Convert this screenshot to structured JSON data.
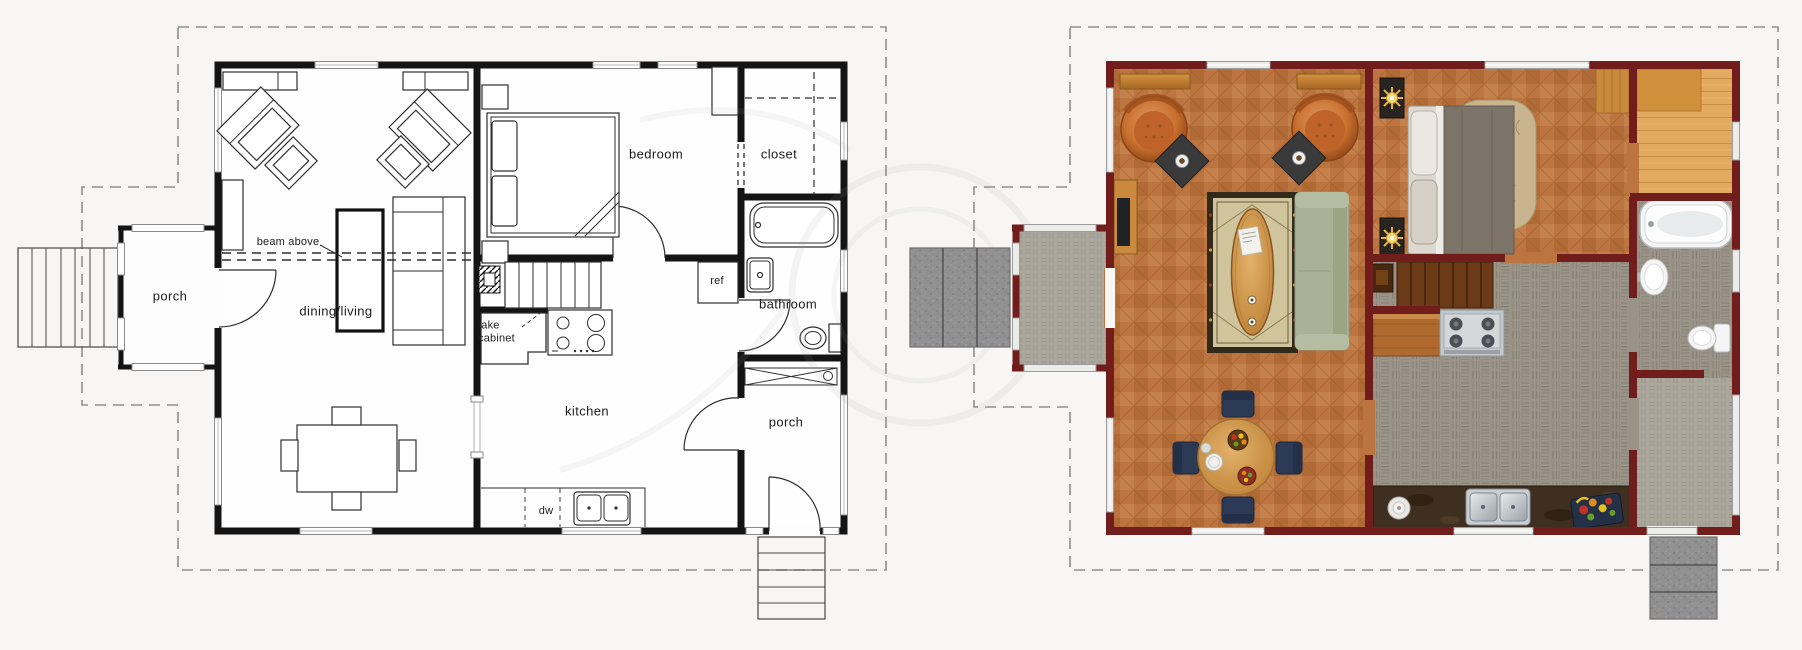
{
  "diagram": {
    "type": "floor-plan-comparison",
    "left_plan": {
      "style": "blueprint",
      "labels": {
        "bedroom": "bedroom",
        "closet": "closet",
        "bathroom": "bathroom",
        "kitchen": "kitchen",
        "dining_living": "dining/living",
        "porch_left": "porch",
        "porch_right": "porch",
        "beam_above": "beam above",
        "fake_cabinet": "fake cabinet",
        "ref": "ref",
        "dw": "dw"
      }
    },
    "right_plan": {
      "style": "rendered-color"
    }
  },
  "palette": {
    "background": "#f7f6f4",
    "blueprint_wall": "#141414",
    "boundary_dash": "#8f8f8f",
    "rendered_wall": "#701d1b",
    "parquet": "#bc7540",
    "tile_gray": "#9a9388",
    "paver_gray": "#aba79d",
    "maple": "#e2aa5f",
    "stone_step": "#8f8f8f",
    "sofa_green": "#a9b296",
    "sofa_green_dark": "#99a584",
    "armchair_orange": "#c9702f",
    "rug_field": "#cfc49b",
    "rug_border": "#33291a",
    "dining_chair_navy": "#2d3a55",
    "counter_dark": "#3f2f21",
    "bed_duvet": "#7d7469",
    "lamp_gold": "#e7b63c",
    "fixture_white": "#f4f5f4",
    "stairs_wood": "#6b3a16"
  }
}
